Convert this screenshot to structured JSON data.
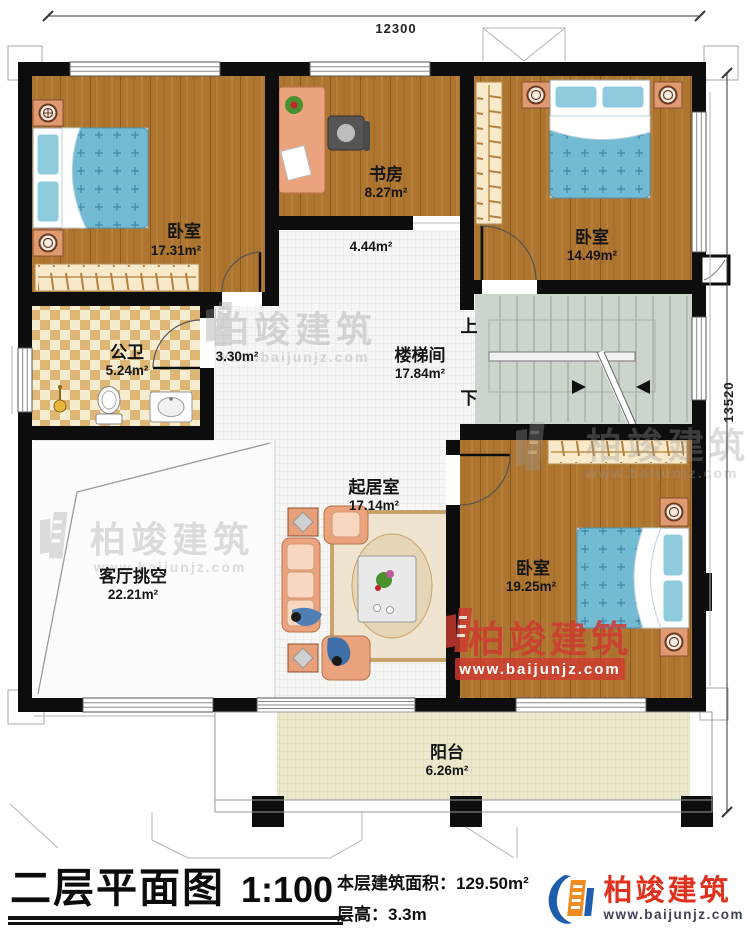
{
  "dimensions": {
    "top": "12300",
    "right": "13520"
  },
  "rooms": {
    "bedroom_top_left": {
      "name": "卧室",
      "area": "17.31m²"
    },
    "study": {
      "name": "书房",
      "area": "8.27m²"
    },
    "bedroom_top_right": {
      "name": "卧室",
      "area": "14.49m²"
    },
    "hallway": {
      "area": "4.44m²"
    },
    "corridor": {
      "area": "3.30m²"
    },
    "bathroom": {
      "name": "公卫",
      "area": "5.24m²"
    },
    "stairwell": {
      "name": "楼梯间",
      "area": "17.84m²"
    },
    "living_void": {
      "name": "客厅挑空",
      "area": "22.21m²"
    },
    "family_room": {
      "name": "起居室",
      "area": "17.14m²"
    },
    "bedroom_bottom_right": {
      "name": "卧室",
      "area": "19.25m²"
    },
    "balcony": {
      "name": "阳台",
      "area": "6.26m²"
    }
  },
  "stairs": {
    "up": "上",
    "down": "下"
  },
  "watermark": {
    "name": "柏竣建筑",
    "url": "www.baijunjz.com"
  },
  "title_block": {
    "title": "二层平面图",
    "scale": "1:100",
    "area_line": "本层建筑面积：129.50m²",
    "height_line": "层高：3.3m"
  },
  "logo": {
    "name": "柏竣建筑",
    "url": "www.baijunjz.com"
  },
  "colors": {
    "wall": "#0d0d0d",
    "wood": "#ad7530",
    "bed_blue": "#72bbd3",
    "furniture_salmon": "#eba37d",
    "stair_floor": "#ccd5cb",
    "balcony_floor": "#ede9ce",
    "logo_red": "#e0301e",
    "logo_blue": "#1d5dab",
    "logo_orange": "#f08c1e"
  }
}
